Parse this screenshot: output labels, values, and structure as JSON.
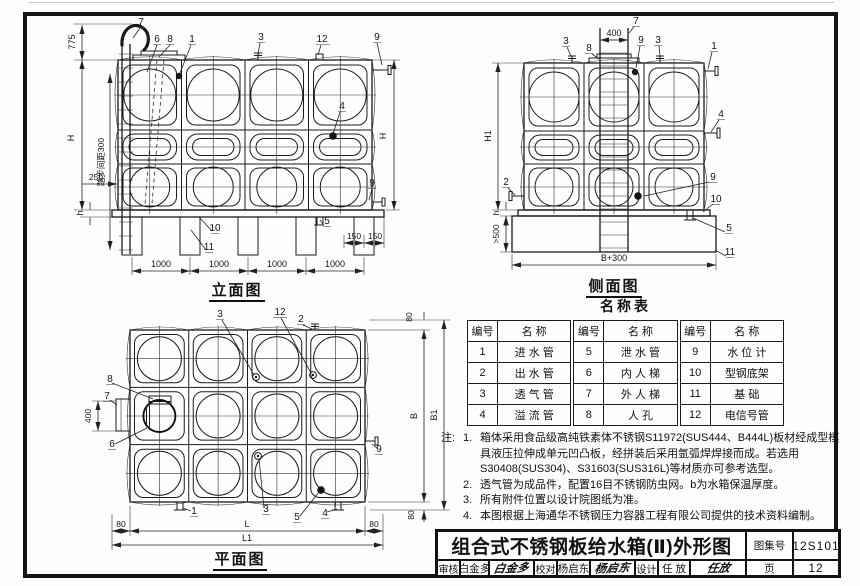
{
  "views": {
    "elevation": {
      "title": "立面图",
      "part_labels": {
        "p1": "1",
        "p3": "3",
        "p4": "4",
        "p5": "5",
        "p6": "6",
        "p7": "7",
        "p8": "8",
        "p9": "9",
        "p10": "10",
        "p11": "11",
        "p12": "12"
      },
      "dims": {
        "d775": "775",
        "step": "踏步间距300",
        "d250": "250",
        "h": "h",
        "H": "H",
        "d150": "150",
        "d1000": "1000"
      }
    },
    "side": {
      "title": "侧面图",
      "part_labels": {
        "p1": "1",
        "p2": "2",
        "p3": "3",
        "p4": "4",
        "p5": "5",
        "p7": "7",
        "p8": "8",
        "p9": "9",
        "p10": "10",
        "p11": "11"
      },
      "dims": {
        "d400": "400",
        "H1": "H1",
        "h": "h",
        "gt500": ">500",
        "Bp300": "B+300"
      }
    },
    "plan": {
      "title": "平面图",
      "part_labels": {
        "p1": "1",
        "p2": "2",
        "p3": "3",
        "p4": "4",
        "p5": "5",
        "p6": "6",
        "p7": "7",
        "p8": "8",
        "p9": "9",
        "p12": "12"
      },
      "dims": {
        "d80": "80",
        "d400": "400",
        "B": "B",
        "B1": "B1",
        "L": "L",
        "L1": "L1"
      }
    }
  },
  "parts_table": {
    "title": "名称表",
    "col_no": "编号",
    "col_name": "名 称",
    "groups": [
      {
        "rows": [
          {
            "no": "1",
            "name": "进 水 管"
          },
          {
            "no": "2",
            "name": "出 水 管"
          },
          {
            "no": "3",
            "name": "透 气 管"
          },
          {
            "no": "4",
            "name": "溢 流 管"
          }
        ]
      },
      {
        "rows": [
          {
            "no": "5",
            "name": "泄 水 管"
          },
          {
            "no": "6",
            "name": "内 人 梯"
          },
          {
            "no": "7",
            "name": "外 人 梯"
          },
          {
            "no": "8",
            "name": "人 孔"
          }
        ]
      },
      {
        "rows": [
          {
            "no": "9",
            "name": "水 位 计"
          },
          {
            "no": "10",
            "name": "型钢底架"
          },
          {
            "no": "11",
            "name": "基 础"
          },
          {
            "no": "12",
            "name": "电信号管"
          }
        ]
      }
    ]
  },
  "notes": {
    "prefix": "注:",
    "items": [
      {
        "num": "1.",
        "text": "箱体采用食品级高纯铁素体不锈钢S11972(SUS444、B444L)板材经成型模具液压拉伸成单元凹凸板，经拼装后采用氩弧焊焊接而成。若选用S30408(SUS304)、S31603(SUS316L)等材质亦可参考选型。"
      },
      {
        "num": "2.",
        "text": "透气管为成品件，配置16目不锈钢防虫网。b为水箱保温厚度。"
      },
      {
        "num": "3.",
        "text": "所有附件位置以设计院图纸为准。"
      },
      {
        "num": "4.",
        "text": "本图根据上海通华不锈钢压力容器工程有限公司提供的技术资料编制。"
      }
    ]
  },
  "titleblock": {
    "title": "组合式不锈钢板给水箱(Ⅱ)外形图",
    "atlas_label": "图集号",
    "atlas_no": "12S101",
    "page_label": "页",
    "page_no": "12",
    "sign_cells": [
      {
        "role": "审核",
        "name": "白金多",
        "sig": "白金多"
      },
      {
        "role": "校对",
        "name": "杨启东",
        "sig": "杨启东"
      },
      {
        "role": "设计",
        "name": "任 放",
        "sig": "任放"
      }
    ]
  }
}
